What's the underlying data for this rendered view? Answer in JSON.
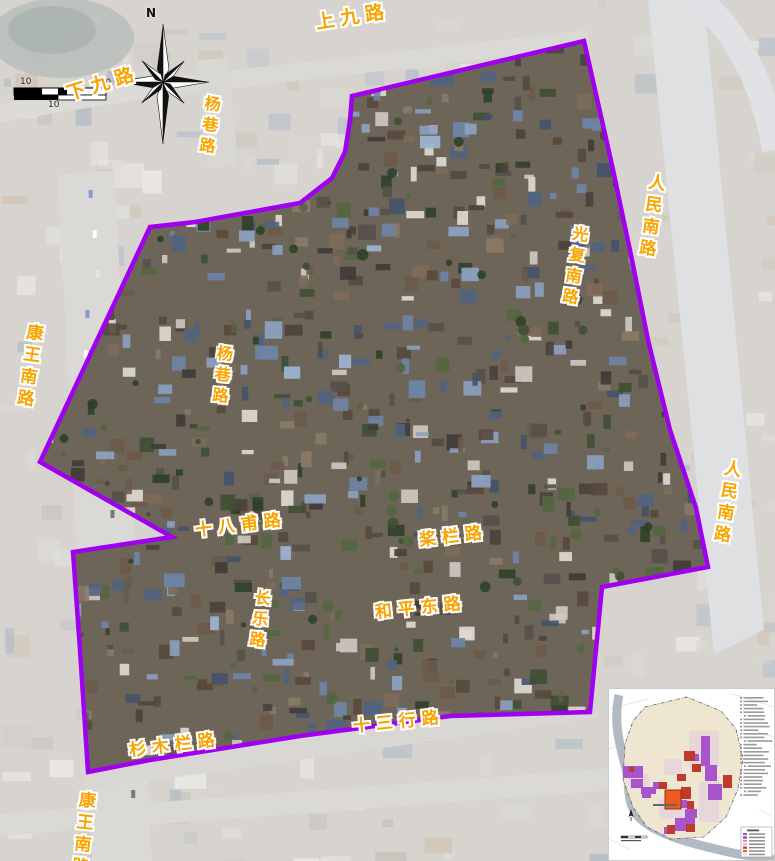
{
  "map": {
    "type": "satellite-plan",
    "boundary_color": "#A000F0",
    "label_color": "#F7A400",
    "compass": {
      "label": "N"
    },
    "scale_bar": {
      "labels": [
        "10",
        "10",
        "100"
      ]
    },
    "road_labels": [
      {
        "text": "上九路",
        "orientation": "h",
        "x": 314,
        "y": 12,
        "rotate": -9,
        "size": 19
      },
      {
        "text": "下九路",
        "orientation": "h",
        "x": 64,
        "y": 84,
        "rotate": -17,
        "size": 19
      },
      {
        "text": "杨巷路",
        "orientation": "v",
        "x": 202,
        "y": 94,
        "rotate": 7,
        "size": 16
      },
      {
        "text": "人民南路",
        "orientation": "v",
        "x": 646,
        "y": 172,
        "rotate": 8,
        "size": 17
      },
      {
        "text": "光复南路",
        "orientation": "v",
        "x": 570,
        "y": 224,
        "rotate": 9,
        "size": 16
      },
      {
        "text": "康王南路",
        "orientation": "v",
        "x": 24,
        "y": 322,
        "rotate": 8,
        "size": 17
      },
      {
        "text": "杨巷路",
        "orientation": "v",
        "x": 214,
        "y": 344,
        "rotate": 6,
        "size": 16
      },
      {
        "text": "人民南路",
        "orientation": "v",
        "x": 722,
        "y": 458,
        "rotate": 9,
        "size": 17
      },
      {
        "text": "十八甫路",
        "orientation": "h",
        "x": 194,
        "y": 521,
        "rotate": -7,
        "size": 17
      },
      {
        "text": "桨栏路",
        "orientation": "h",
        "x": 418,
        "y": 531,
        "rotate": -7,
        "size": 17
      },
      {
        "text": "长乐路",
        "orientation": "v",
        "x": 252,
        "y": 588,
        "rotate": 7,
        "size": 16
      },
      {
        "text": "和平东路",
        "orientation": "h",
        "x": 374,
        "y": 603,
        "rotate": -6,
        "size": 17
      },
      {
        "text": "十三行路",
        "orientation": "h",
        "x": 352,
        "y": 717,
        "rotate": -6,
        "size": 17
      },
      {
        "text": "杉木栏路",
        "orientation": "h",
        "x": 128,
        "y": 741,
        "rotate": -7,
        "size": 17
      },
      {
        "text": "康王南路",
        "orientation": "v",
        "x": 76,
        "y": 790,
        "rotate": 6,
        "size": 17
      }
    ]
  },
  "inset": {
    "background": "#ffffff",
    "old_city_fill": "#efe6d2",
    "river_color": "#adb6c0",
    "highlight_color": "#f05a1e",
    "legend_colors": [
      "#a855cc",
      "#7d3fa8",
      "#d98ec0",
      "#e8b4c8",
      "#bf3a2b",
      "#f05a1e",
      "#efe6d2"
    ]
  }
}
